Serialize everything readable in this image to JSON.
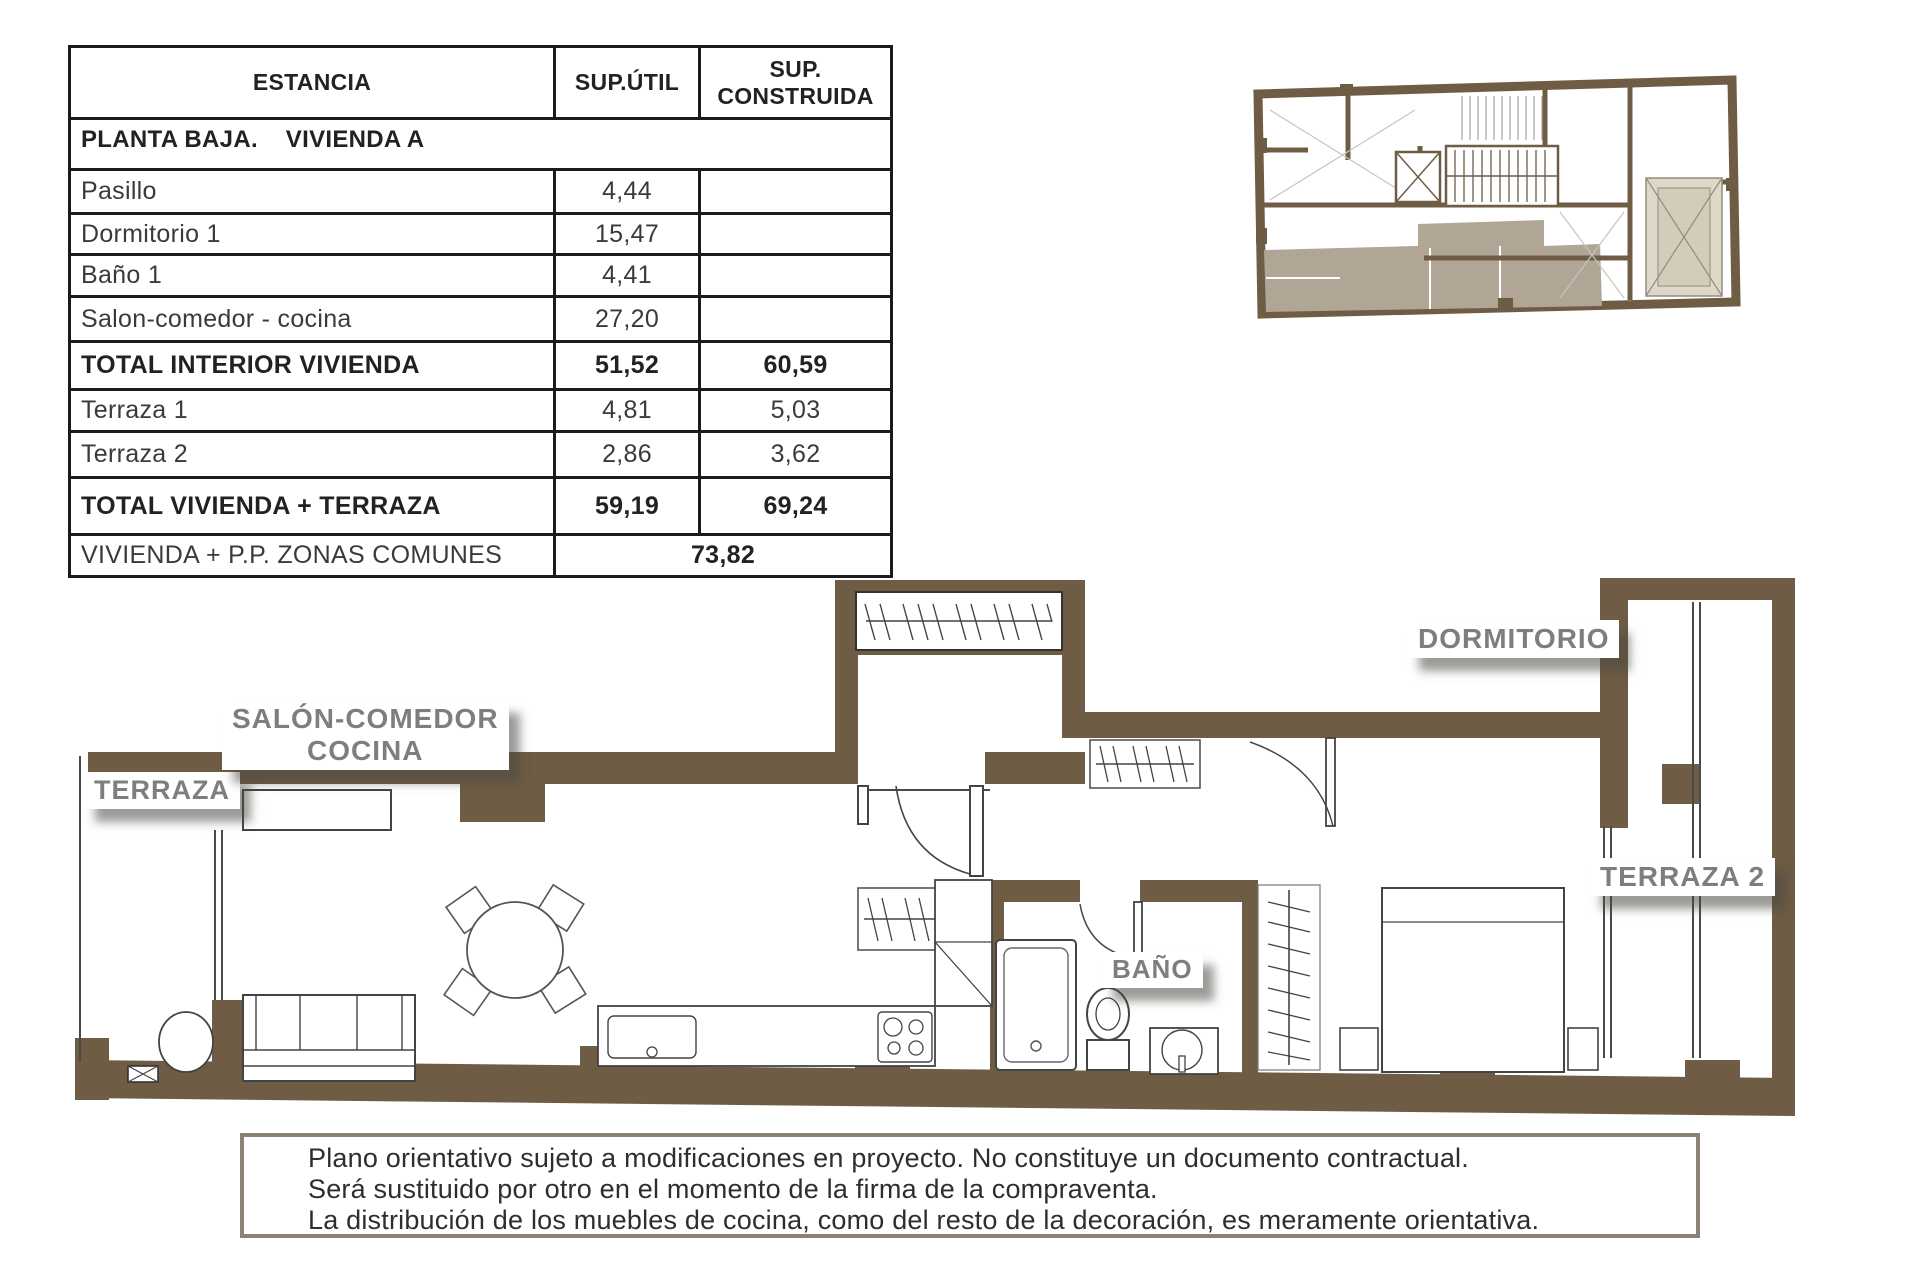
{
  "colors": {
    "wall_brown": "#6e5c44",
    "unit_highlight": "#b1a595",
    "patio_fill": "#ddd8c8",
    "label_gray": "#7e7e7e",
    "table_border": "#1b1b1b",
    "disclaimer_border": "#8a8373"
  },
  "table": {
    "headers": {
      "estancia": "ESTANCIA",
      "util": "SUP.ÚTIL",
      "construida": "SUP.\nCONSTRUIDA"
    },
    "section": "PLANTA BAJA.    VIVIENDA A",
    "rows": [
      {
        "label": "Pasillo",
        "util": "4,44",
        "construida": ""
      },
      {
        "label": "Dormitorio 1",
        "util": "15,47",
        "construida": ""
      },
      {
        "label": "Baño 1",
        "util": "4,41",
        "construida": ""
      },
      {
        "label": "Salon-comedor - cocina",
        "util": "27,20",
        "construida": ""
      },
      {
        "label": "TOTAL INTERIOR VIVIENDA",
        "util": "51,52",
        "construida": "60,59"
      },
      {
        "label": "Terraza 1",
        "util": "4,81",
        "construida": "5,03"
      },
      {
        "label": "Terraza 2",
        "util": "2,86",
        "construida": "3,62"
      },
      {
        "label": "TOTAL VIVIENDA + TERRAZA",
        "util": "59,19",
        "construida": "69,24"
      }
    ],
    "footer": {
      "label": "VIVIENDA + P.P. ZONAS COMUNES",
      "value": "73,82"
    }
  },
  "plan_labels": {
    "terraza": "TERRAZA",
    "salon_line1": "SALÓN-COMEDOR",
    "salon_line2": "COCINA",
    "bano": "BAÑO",
    "dormitorio": "DORMITORIO",
    "terraza2": "TERRAZA 2"
  },
  "disclaimer": {
    "line1": "Plano orientativo sujeto a modificaciones en proyecto. No constituye un documento contractual.",
    "line2": "Será sustituido por otro en el momento de la firma de la compraventa.",
    "line3": "La distribución de los muebles de cocina, como del resto de la decoración, es meramente orientativa."
  }
}
